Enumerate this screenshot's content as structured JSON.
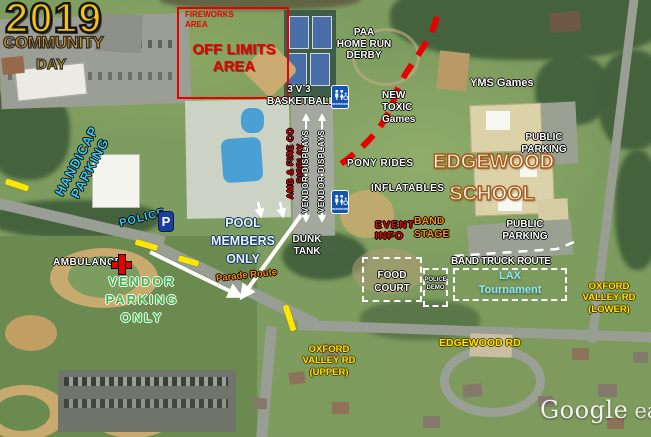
{
  "palette": {
    "label-white": "#ffffff",
    "label-red": "#e60000",
    "label-yellow": "#ffe600",
    "label-cyan": "#38c8f5",
    "label-green": "#3cb549",
    "label-orange": "#ff9100",
    "label-gold": "#f3c117",
    "title-orange": "#f0a81c",
    "school-outline": "#a85a14",
    "pool-text": "#e8f4ff",
    "lax-cyan": "#8fe8f0",
    "restroom-blue": "#1555b0",
    "parking-blue": "#1a3fa0",
    "pool-water": "#4a9fd4"
  },
  "title": {
    "year": "2019",
    "community": "COMMUNITY",
    "day": "DAY"
  },
  "zones": {
    "fireworks_area": "FIREWORKS\nAREA",
    "off_limits": "OFF LIMITS\nAREA",
    "paa_derby": "PAA\nHOME RUN\nDERBY",
    "yms_games": "YMS Games",
    "new_toxic": "NEW\nTOXIC\nGames",
    "basketball": "3 V 3\nBASKETBALL",
    "pony_rides": "PONY RIDES",
    "inflatables": "INFLATABLES",
    "edgewood_school": "EDGEWOOD\nSCHOOL",
    "public_parking_upper": "PUBLIC\nPARKING",
    "public_parking_lower": "PUBLIC\nPARKING",
    "event_info": "EVENT\nINFO",
    "band_stage": "BAND\nSTAGE",
    "amb_fire": "AMB & FIRE CO DISPLAY",
    "vendor_displays_left": "VENDOR DISPLAYS",
    "vendor_displays_right": "VENDOR DISPLAYS",
    "pool_members": "POOL\nMEMBERS\nONLY",
    "dunk_tank": "DUNK\nTANK",
    "parade_route": "Parade Route",
    "ambulance": "AMBULANCE",
    "vendor_parking": "VENDOR\nPARKING\nONLY",
    "handicap_parking": "HANDICAP\nPARKING",
    "police": "POLICE",
    "food_court": "FOOD\nCOURT",
    "police_demo": "POLICE\nDEMO",
    "band_truck_route": "BAND TRUCK ROUTE",
    "lax_tournament": "LAX\nTournament",
    "oxford_lower": "OXFORD\nVALLEY RD\n(LOWER)",
    "oxford_upper": "OXFORD\nVALLEY RD\n(UPPER)",
    "edgewood_rd": "EDGEWOOD RD"
  },
  "icons": {
    "parking_letter": "P",
    "restroom_caption": "RESTROOM"
  },
  "watermark": {
    "google": "Google",
    "earth": "earth"
  }
}
